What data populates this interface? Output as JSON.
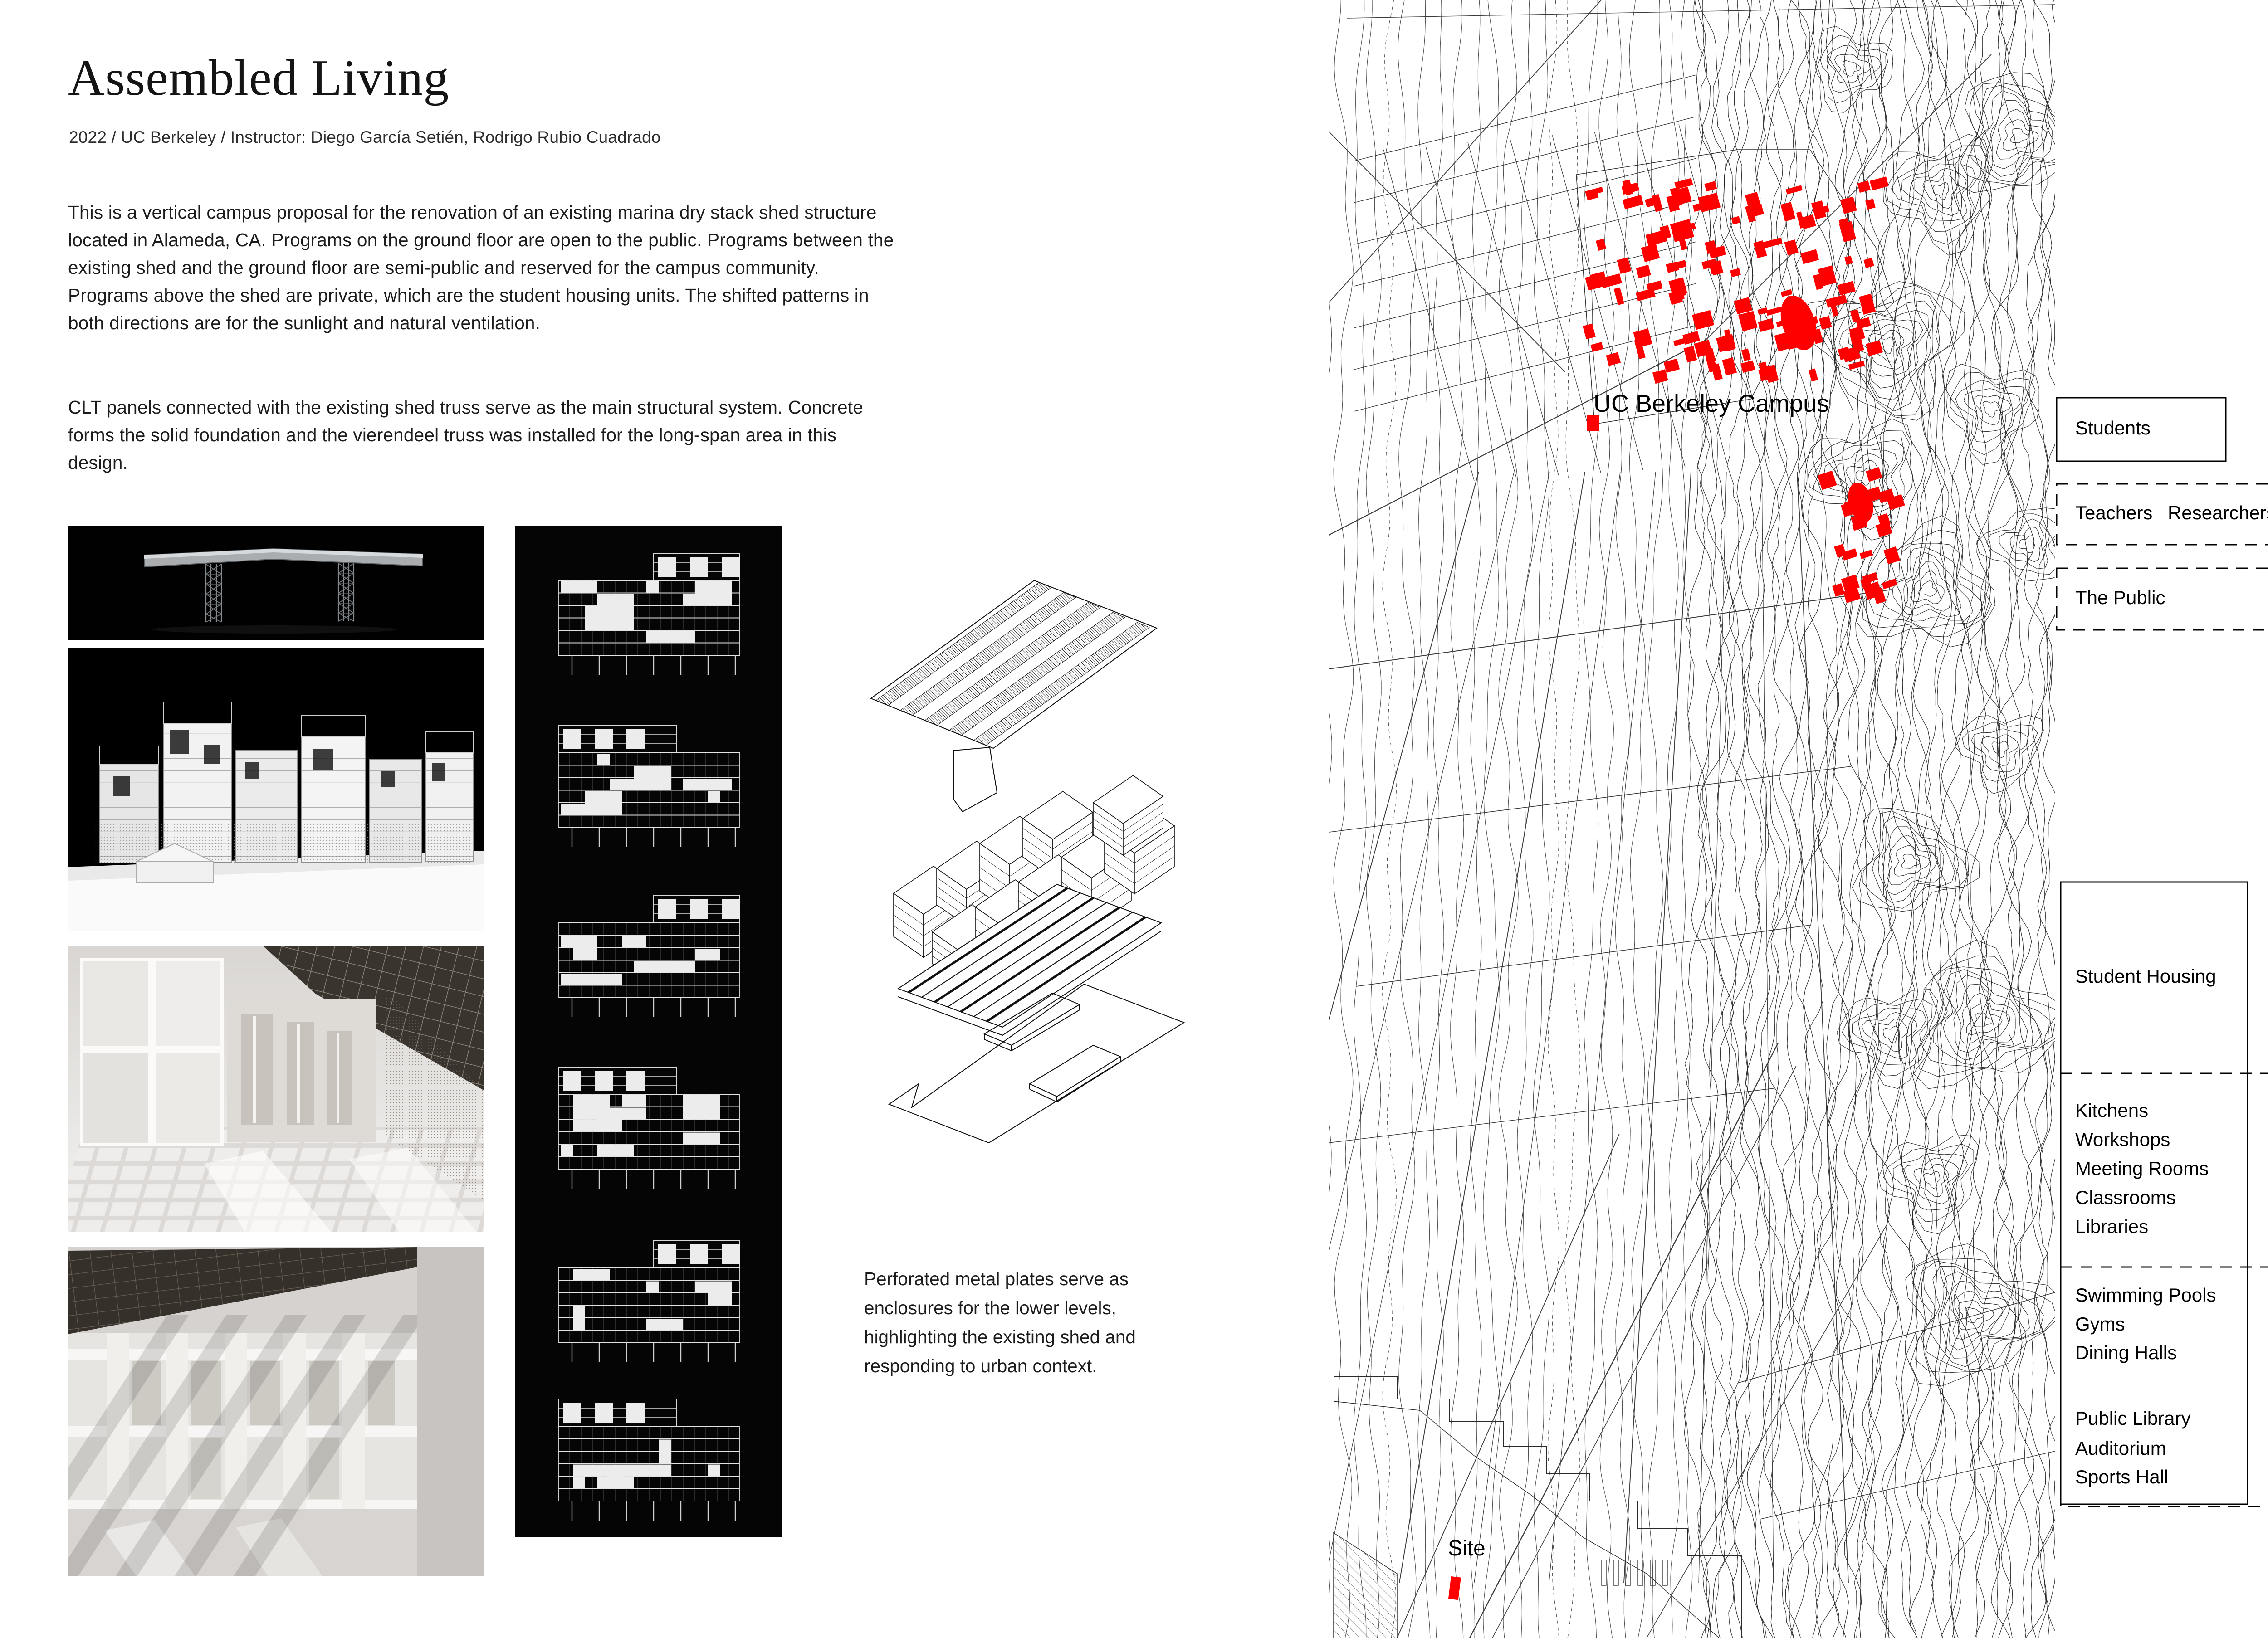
{
  "header": {
    "title": "Assembled Living",
    "subtitle": "2022 / UC Berkeley / Instructor: Diego García Setién, Rodrigo Rubio Cuadrado"
  },
  "description": {
    "para1": "This is a vertical campus proposal for the renovation of an existing marina dry stack shed structure located in Alameda, CA. Programs on the ground floor are open to the public. Programs between the existing shed and the ground floor are semi-public and reserved for the campus community. Programs above the shed are private, which are the student housing units. The shifted patterns in both directions are for the sunlight and natural ventilation.",
    "para2": "CLT panels connected with the existing shed truss serve as the main structural system. Concrete forms the solid foundation and the vierendeel truss was installed for the long-span area in this design."
  },
  "figures": {
    "caption": "Perforated metal plates serve as enclosures for the lower levels, highlighting the existing shed and responding to urban context."
  },
  "map": {
    "campus_label": "UC Berkeley Campus",
    "site_label": "Site",
    "building_color": "#ff0000"
  },
  "legend": {
    "users": [
      {
        "style": "solid",
        "labels": [
          "Students"
        ]
      },
      {
        "style": "dashed",
        "labels": [
          "Teachers",
          "Researchers"
        ]
      },
      {
        "style": "dashed",
        "labels": [
          "The Public"
        ]
      }
    ],
    "programs": {
      "private": [
        "Student Housing"
      ],
      "semi_public": [
        "Kitchens",
        "Workshops",
        "Meeting Rooms",
        "Classrooms",
        "Libraries"
      ],
      "public_recreation": [
        "Swimming Pools",
        "Gyms",
        "Dining Halls"
      ],
      "public_culture": [
        "Public Library",
        "Auditorium",
        "Sports Hall"
      ]
    }
  }
}
